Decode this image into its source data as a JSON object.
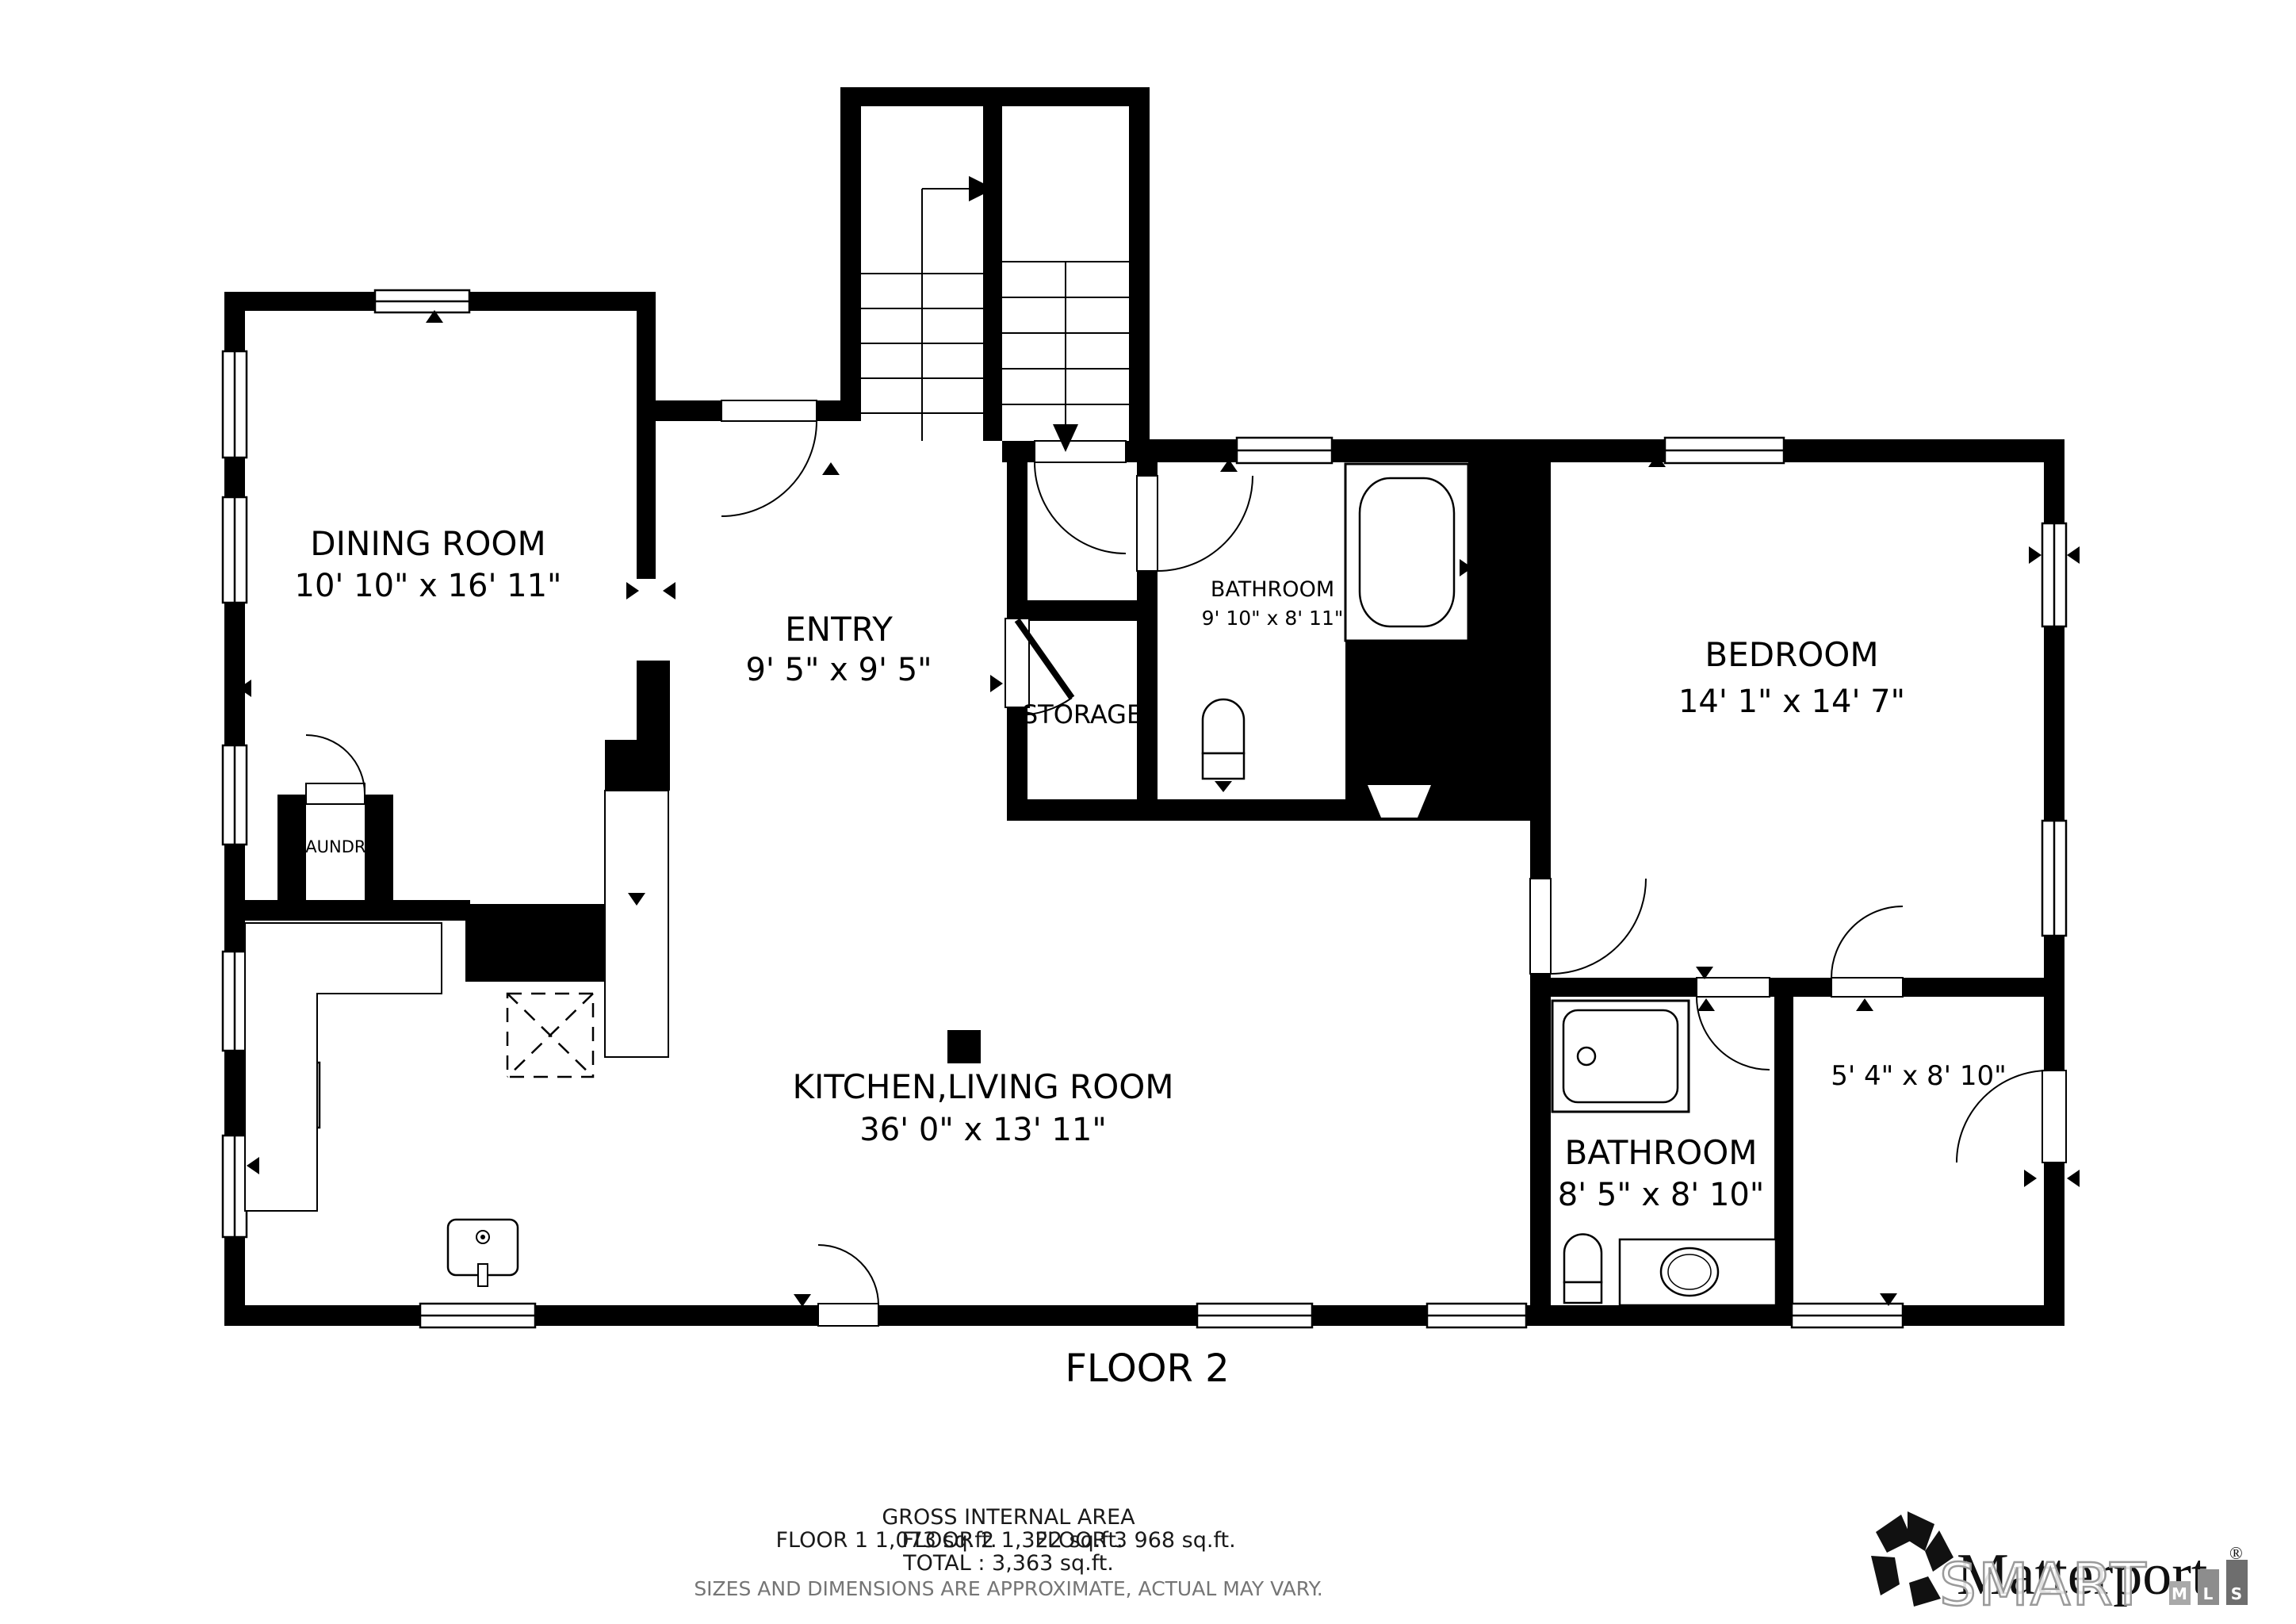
{
  "floor_label": "FLOOR 2",
  "rooms": {
    "dining": {
      "name": "DINING ROOM",
      "dims": "10' 10\" x 16' 11\""
    },
    "entry": {
      "name": "ENTRY",
      "dims": "9' 5\" x 9' 5\""
    },
    "storage": {
      "name": "STORAGE"
    },
    "laundry": {
      "name": "LAUNDRY"
    },
    "bathroom_top": {
      "name": "BATHROOM",
      "dims": "9' 10\" x 8' 11\""
    },
    "bedroom": {
      "name": "BEDROOM",
      "dims": "14' 1\" x 14' 7\""
    },
    "kitchen_living": {
      "name": "KITCHEN,LIVING ROOM",
      "dims": "36' 0\" x 13' 11\""
    },
    "bathroom_bottom": {
      "name": "BATHROOM",
      "dims": "8' 5\" x 8' 10\""
    },
    "closet": {
      "dims": "5' 4\" x 8' 10\""
    }
  },
  "footer": {
    "area_title": "GROSS INTERNAL AREA",
    "floor1": "FLOOR 1 1,073 sq.ft.",
    "floor2": "FLOOR 2 1,322 sq.ft.",
    "floor3": "FLOOR 3 968 sq.ft.",
    "total": "TOTAL :  3,363 sq.ft.",
    "disclaimer": "SIZES AND DIMENSIONS ARE APPROXIMATE, ACTUAL MAY VARY."
  },
  "branding": {
    "matterport": "Matterport",
    "registered": "®",
    "smart": "SMART",
    "mls_letters": [
      "M",
      "L",
      "S"
    ]
  },
  "colors": {
    "wall": "#000000",
    "background": "#ffffff",
    "disclaimer_gray": "#757575",
    "smart_outline_gray": "#9a9a9a",
    "mls_m": "#a9a9a9",
    "mls_l": "#8d8d8d",
    "mls_s": "#6e6e6e"
  }
}
